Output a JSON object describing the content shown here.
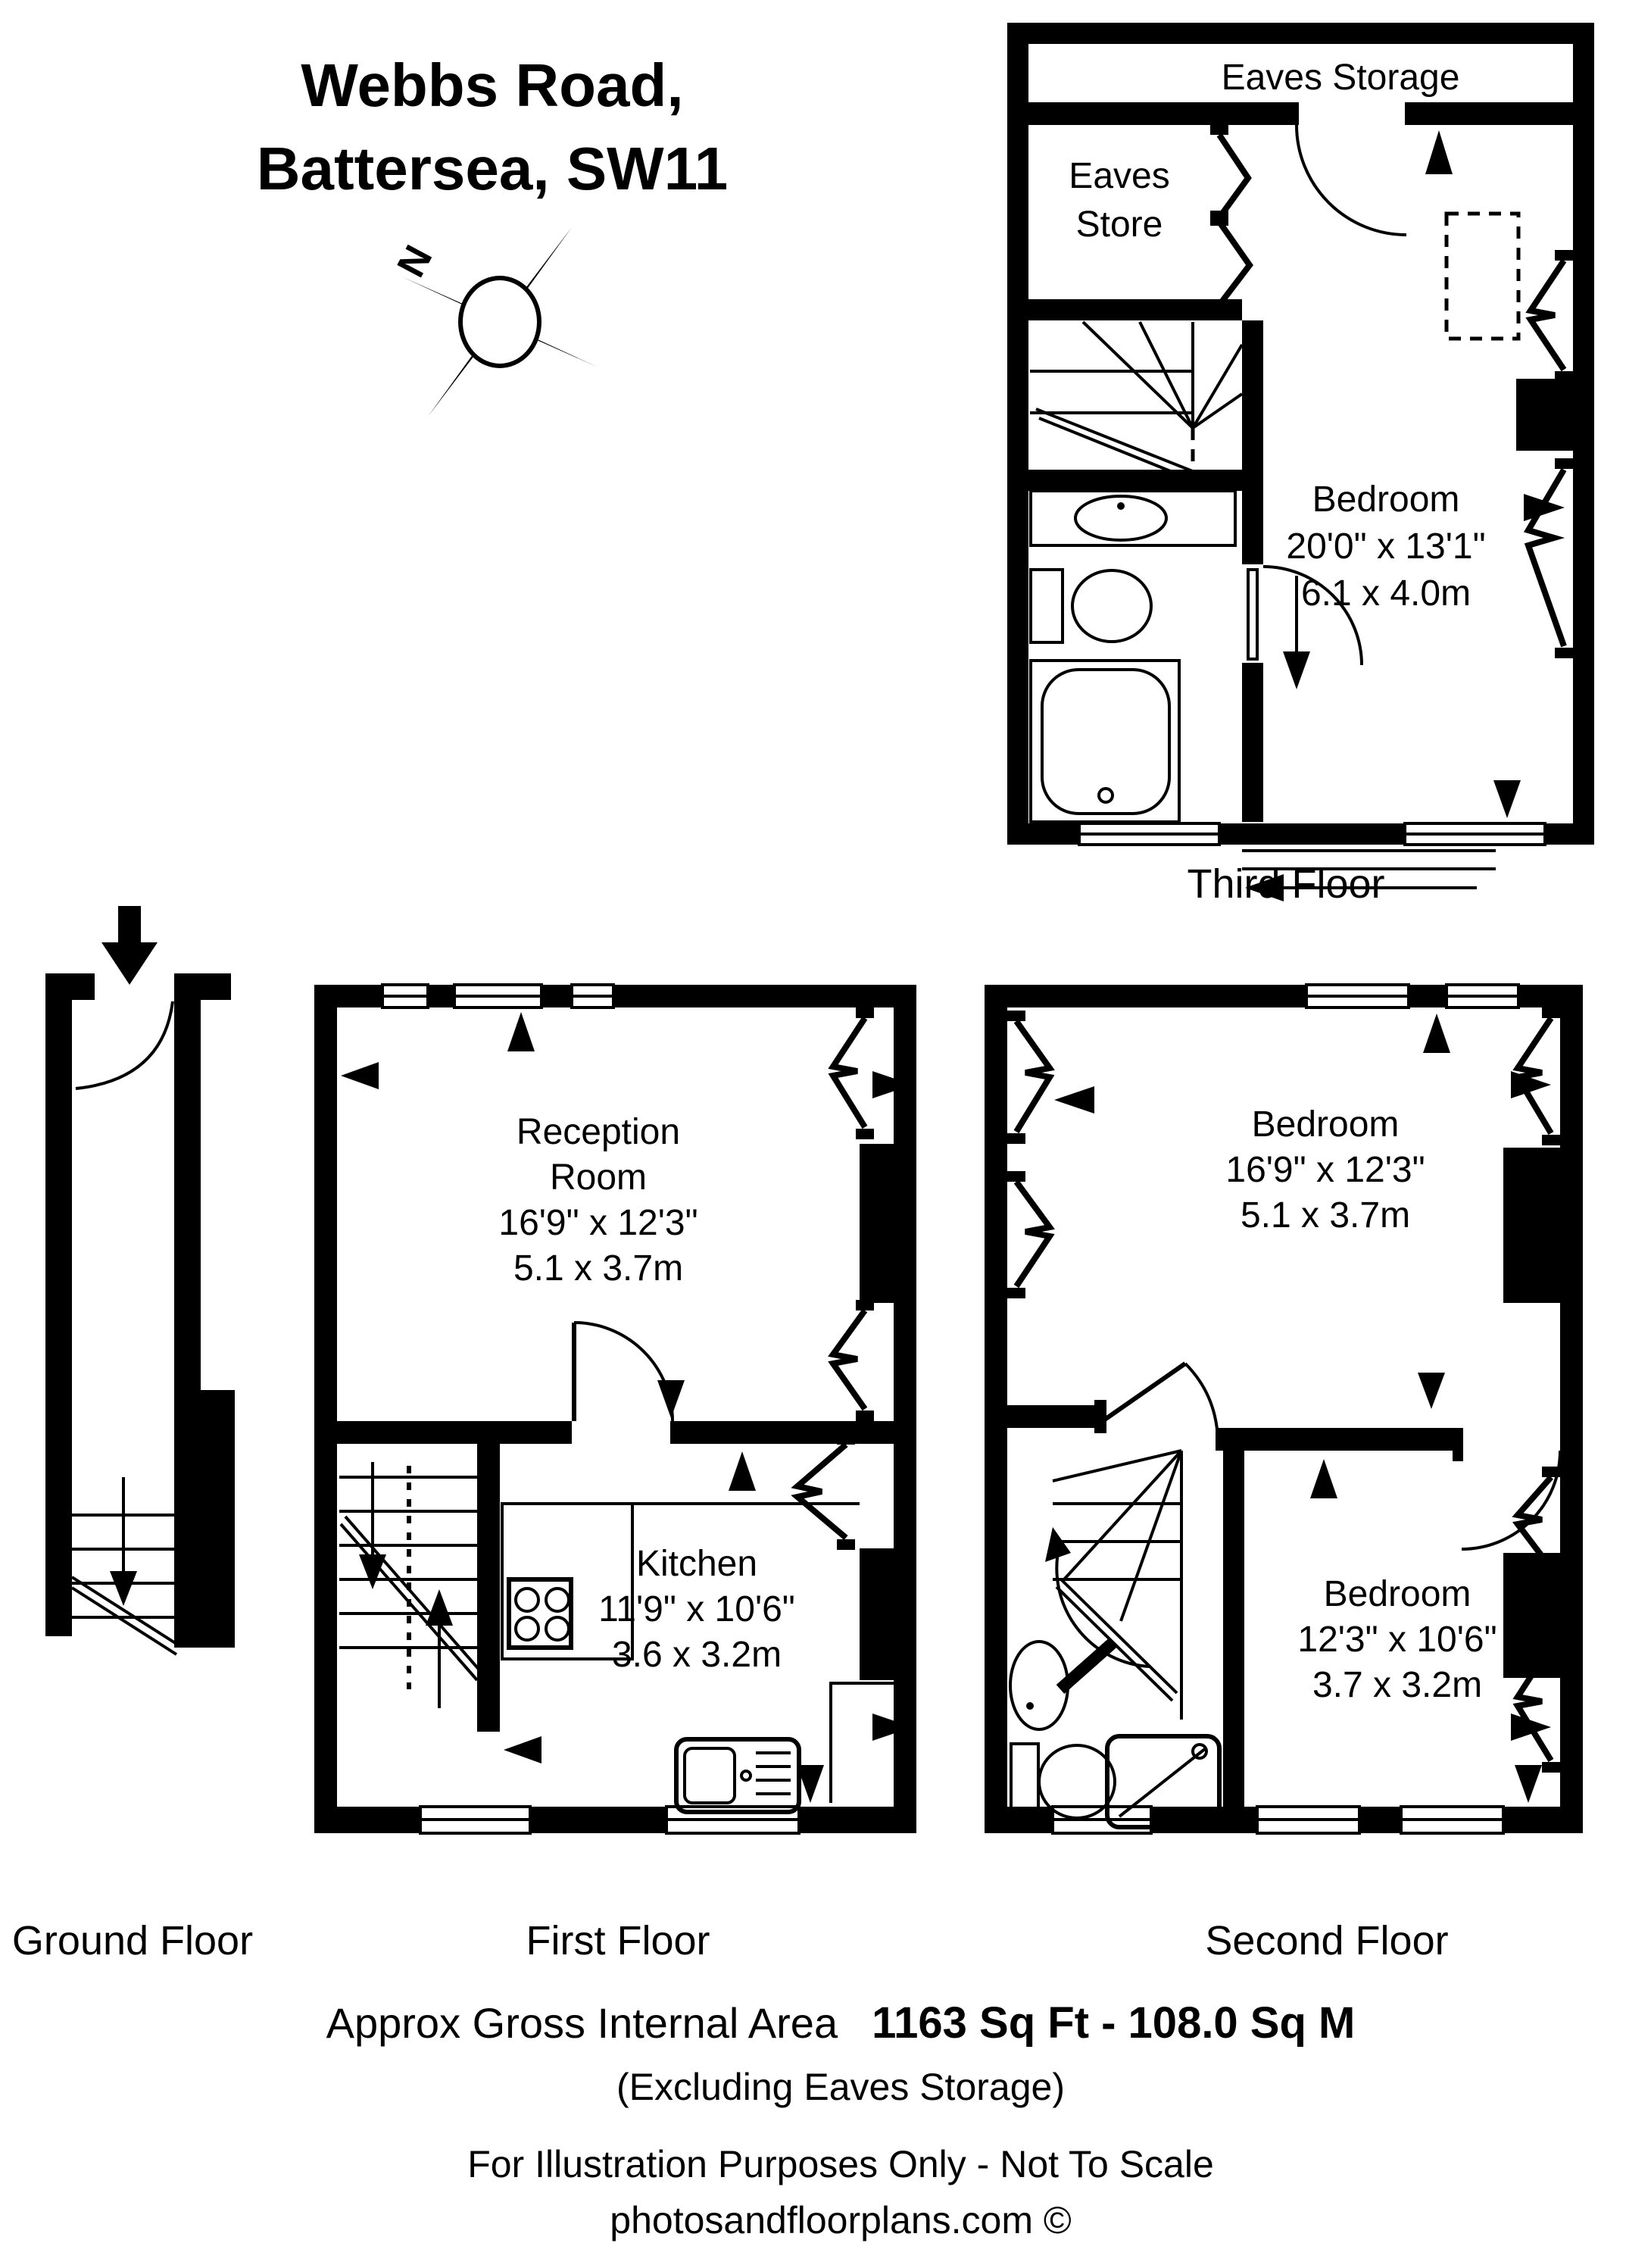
{
  "title": {
    "line1": "Webbs Road,",
    "line2": "Battersea, SW11"
  },
  "compass": {
    "north": "N"
  },
  "floors": {
    "ground": {
      "label": "Ground Floor"
    },
    "first": {
      "label": "First Floor",
      "reception": {
        "line1": "Reception",
        "line2": "Room",
        "imperial": "16'9\" x 12'3\"",
        "metric": "5.1 x 3.7m"
      },
      "kitchen": {
        "name": "Kitchen",
        "imperial": "11'9\" x 10'6\"",
        "metric": "3.6 x 3.2m"
      }
    },
    "second": {
      "label": "Second Floor",
      "bedroom_front": {
        "name": "Bedroom",
        "imperial": "16'9\" x 12'3\"",
        "metric": "5.1 x 3.7m"
      },
      "bedroom_back": {
        "name": "Bedroom",
        "imperial": "12'3\" x 10'6\"",
        "metric": "3.7 x 3.2m"
      }
    },
    "third": {
      "label": "Third Floor",
      "eaves_storage": "Eaves Storage",
      "eaves_store_line1": "Eaves",
      "eaves_store_line2": "Store",
      "bedroom": {
        "name": "Bedroom",
        "imperial": "20'0\" x 13'1\"",
        "metric": "6.1 x 4.0m"
      }
    }
  },
  "footer": {
    "area_label": "Approx Gross Internal Area",
    "area_value": "1163 Sq Ft  -  108.0 Sq M",
    "exclusion": "(Excluding Eaves Storage)",
    "disclaimer": "For Illustration Purposes Only - Not To Scale",
    "credit": "photosandfloorplans.com ©"
  },
  "colors": {
    "ink": "#000000",
    "paper": "#ffffff"
  }
}
